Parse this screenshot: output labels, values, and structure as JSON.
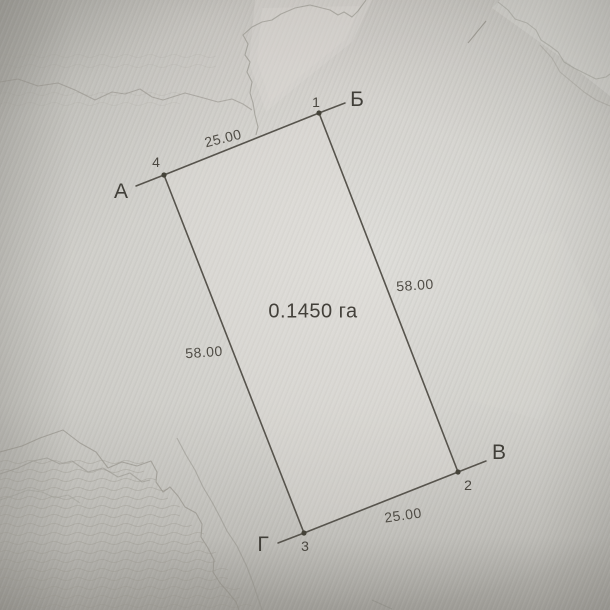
{
  "plan": {
    "area_label": "0.1450 га",
    "corner_letters": {
      "a": "А",
      "b": "Б",
      "v": "В",
      "g": "Г"
    },
    "corner_numbers": {
      "n1": "1",
      "n2": "2",
      "n3": "3",
      "n4": "4"
    },
    "dimensions": {
      "top": "25.00",
      "right": "58.00",
      "bottom": "25.00",
      "left": "58.00"
    }
  },
  "colors": {
    "paper_base": "#c8c7c2",
    "paper_highlight": "#d6d5d1",
    "paper_shadow": "#a5a39c",
    "boundary_line": "#57544d",
    "contour_line": "#8f8d85",
    "text": "#47443e"
  }
}
